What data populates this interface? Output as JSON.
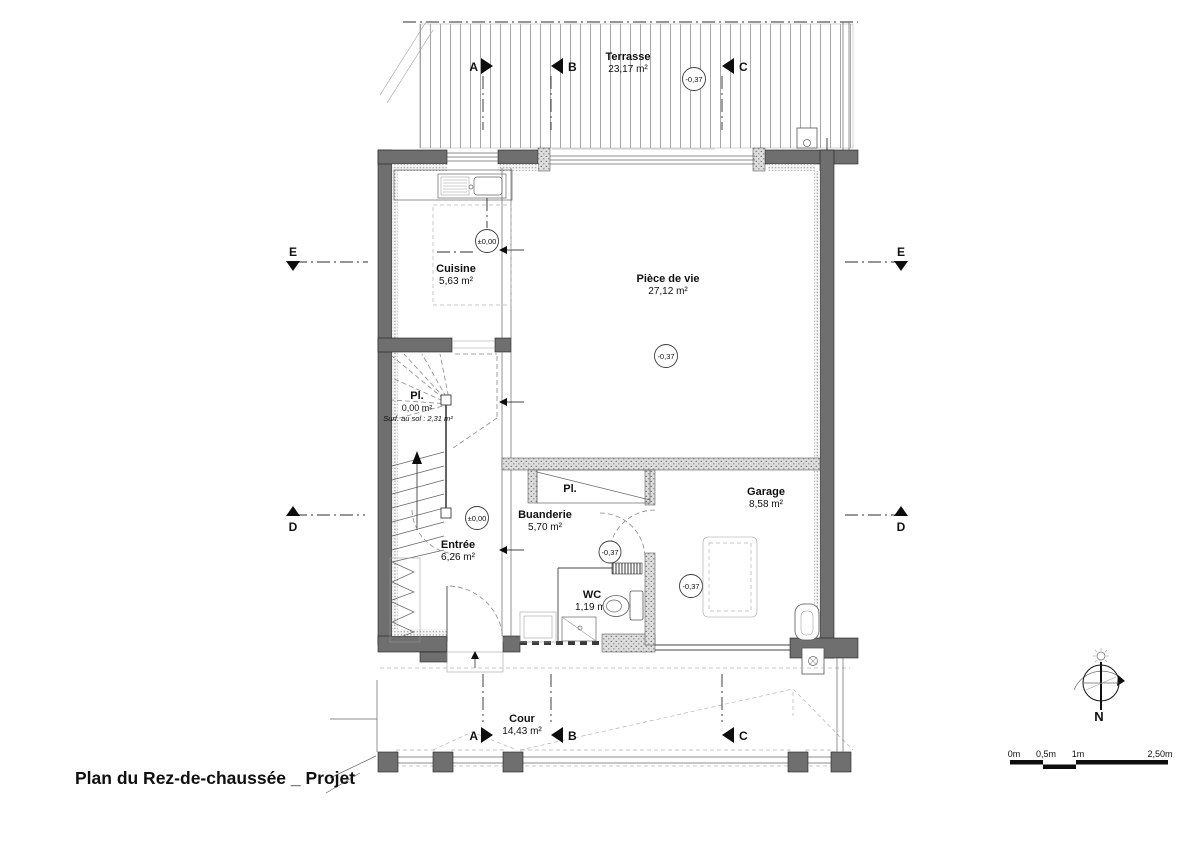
{
  "title": "Plan du Rez-de-chaussée _ Projet",
  "colors": {
    "wall_fill": "#6f6f6f",
    "line": "#333333",
    "background": "#ffffff"
  },
  "rooms": {
    "terrasse": {
      "name": "Terrasse",
      "area": "23,17 m²"
    },
    "cuisine": {
      "name": "Cuisine",
      "area": "5,63 m²"
    },
    "piece_de_vie": {
      "name": "Pièce de vie",
      "area": "27,12 m²"
    },
    "placard_stair": {
      "name": "Pl.",
      "area": "0,00 m²",
      "note": "Surf. au sol : 2,31 m²"
    },
    "entree": {
      "name": "Entrée",
      "area": "6,26 m²"
    },
    "buanderie": {
      "name": "Buanderie",
      "area": "5,70 m²"
    },
    "placard_hall": {
      "name": "Pl."
    },
    "wc": {
      "name": "WC",
      "area": "1,19 m²"
    },
    "garage": {
      "name": "Garage",
      "area": "8,58 m²"
    },
    "cour": {
      "name": "Cour",
      "area": "14,43 m²"
    }
  },
  "levels": {
    "terrasse": "-0,37",
    "cuisine": "±0,00",
    "piece_de_vie": "-0,37",
    "entree": "±0,00",
    "hall": "-0,37",
    "garage": "-0,37"
  },
  "section_markers": {
    "a": "A",
    "b": "B",
    "c": "C",
    "d": "D",
    "e": "E"
  },
  "compass": {
    "north": "N"
  },
  "scale_bar": {
    "labels": [
      "0m",
      "0,5m",
      "1m",
      "2,50m"
    ]
  }
}
